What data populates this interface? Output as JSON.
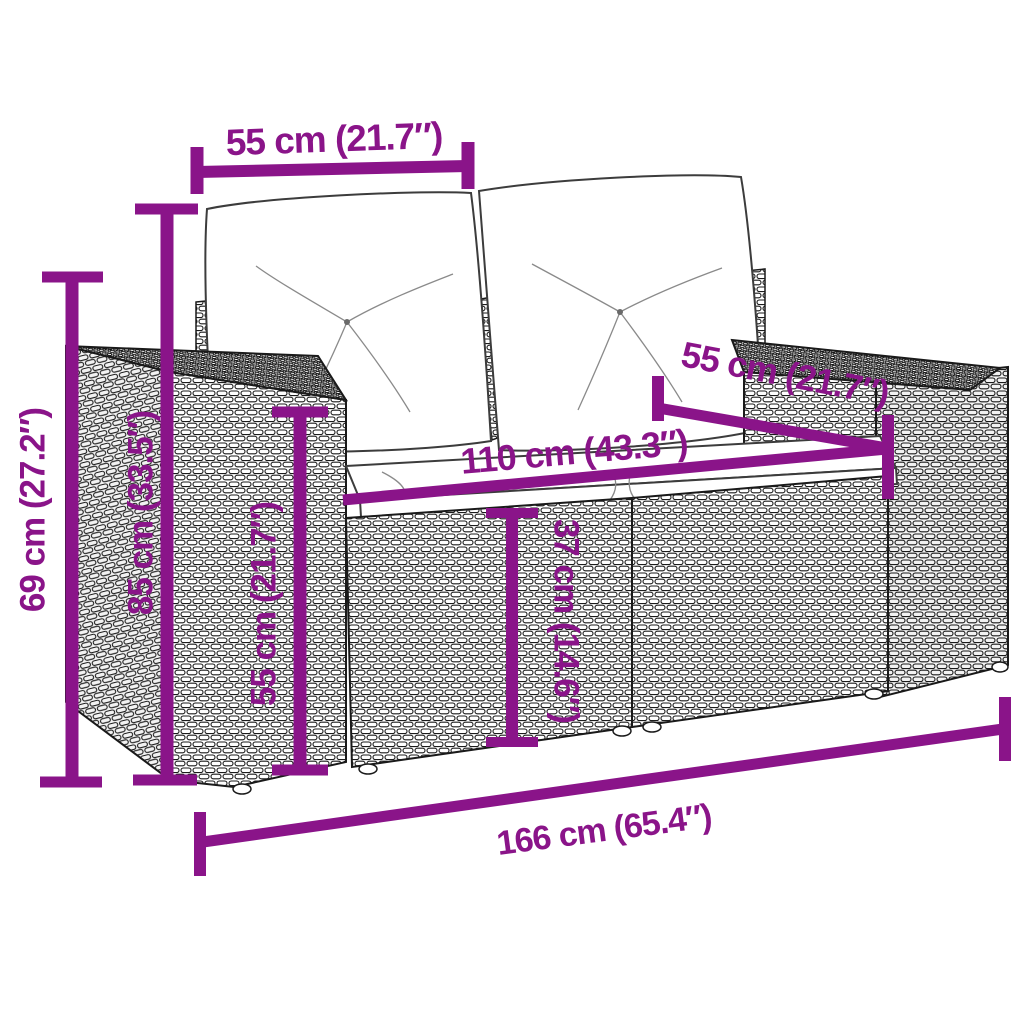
{
  "diagram": {
    "background_color": "#ffffff",
    "accent_color": "#8A1489",
    "ink_color": "#1a1a1a",
    "dimensions": {
      "back_cushion_width": {
        "label": "55 cm (21.7″)"
      },
      "total_height": {
        "label": "69 cm (27.2″)"
      },
      "back_height": {
        "label": "85 cm (33.5″)"
      },
      "arm_height": {
        "label": "55 cm (21.7″)"
      },
      "seat_width": {
        "label": "110 cm (43.3″)"
      },
      "seat_depth": {
        "label": "55 cm (21.7″)"
      },
      "seat_height": {
        "label": "37 cm (14.6″)"
      },
      "total_width": {
        "label": "166 cm (65.4″)"
      }
    }
  }
}
